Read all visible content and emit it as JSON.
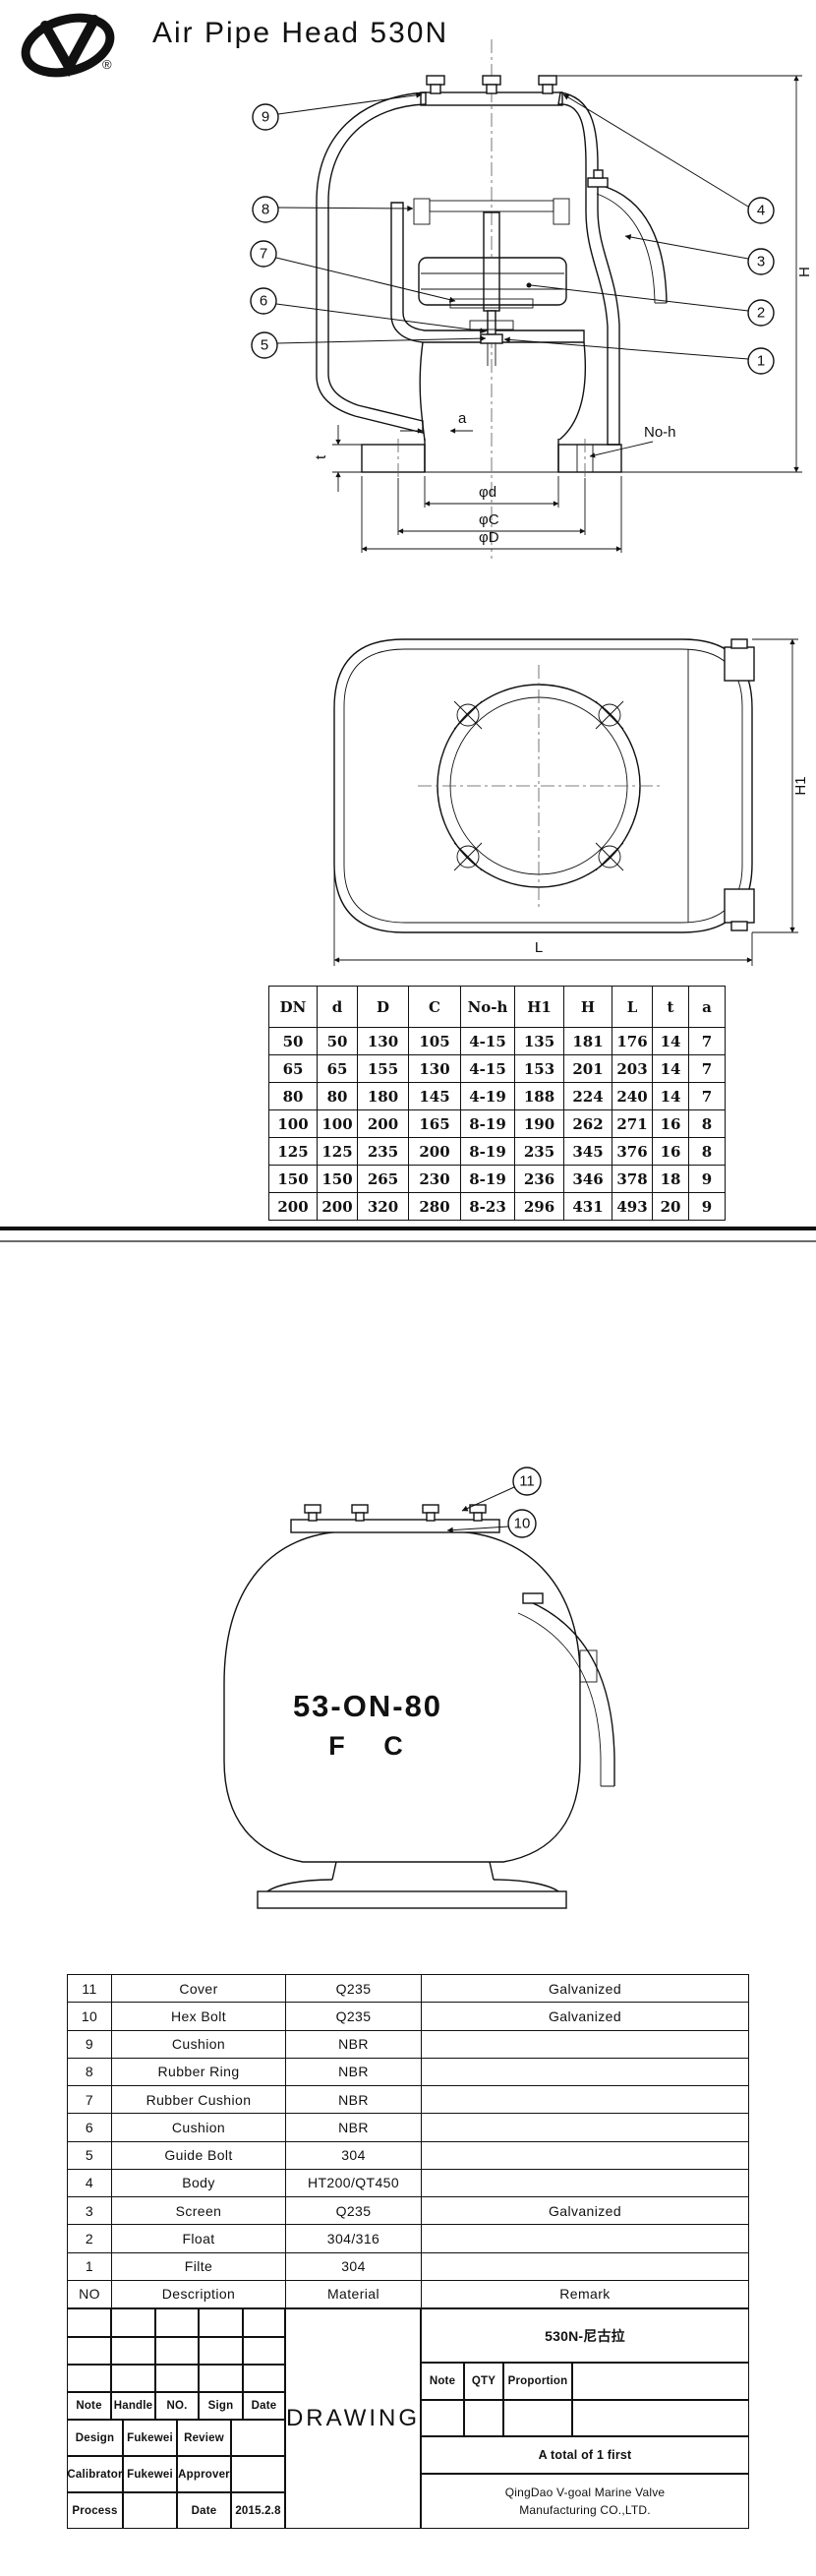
{
  "header": {
    "title": "Air Pipe Head 530N",
    "registered": "®"
  },
  "fig1": {
    "callouts_left": [
      "9",
      "8",
      "7",
      "6",
      "5"
    ],
    "callouts_right": [
      "4",
      "3",
      "2",
      "1"
    ],
    "labels": {
      "a": "a",
      "t": "t",
      "no_h": "No-h",
      "H": "H",
      "phi_d": "φd",
      "phi_C": "φC",
      "phi_D": "φD"
    }
  },
  "fig2": {
    "labels": {
      "H1": "H1",
      "L": "L"
    }
  },
  "fig3": {
    "callouts": [
      "11",
      "10"
    ],
    "model": "53-ON-80",
    "type_letters": "F C"
  },
  "dims_table": {
    "headers": [
      "DN",
      "d",
      "D",
      "C",
      "No-h",
      "H1",
      "H",
      "L",
      "t",
      "a"
    ],
    "rows": [
      [
        "50",
        "50",
        "130",
        "105",
        "4-15",
        "135",
        "181",
        "176",
        "14",
        "7"
      ],
      [
        "65",
        "65",
        "155",
        "130",
        "4-15",
        "153",
        "201",
        "203",
        "14",
        "7"
      ],
      [
        "80",
        "80",
        "180",
        "145",
        "4-19",
        "188",
        "224",
        "240",
        "14",
        "7"
      ],
      [
        "100",
        "100",
        "200",
        "165",
        "8-19",
        "190",
        "262",
        "271",
        "16",
        "8"
      ],
      [
        "125",
        "125",
        "235",
        "200",
        "8-19",
        "235",
        "345",
        "376",
        "16",
        "8"
      ],
      [
        "150",
        "150",
        "265",
        "230",
        "8-19",
        "236",
        "346",
        "378",
        "18",
        "9"
      ],
      [
        "200",
        "200",
        "320",
        "280",
        "8-23",
        "296",
        "431",
        "493",
        "20",
        "9"
      ]
    ]
  },
  "parts_table": {
    "rows": [
      [
        "11",
        "Cover",
        "Q235",
        "Galvanized"
      ],
      [
        "10",
        "Hex Bolt",
        "Q235",
        "Galvanized"
      ],
      [
        "9",
        "Cushion",
        "NBR",
        ""
      ],
      [
        "8",
        "Rubber Ring",
        "NBR",
        ""
      ],
      [
        "7",
        "Rubber Cushion",
        "NBR",
        ""
      ],
      [
        "6",
        "Cushion",
        "NBR",
        ""
      ],
      [
        "5",
        "Guide Bolt",
        "304",
        ""
      ],
      [
        "4",
        "Body",
        "HT200/QT450",
        ""
      ],
      [
        "3",
        "Screen",
        "Q235",
        "Galvanized"
      ],
      [
        "2",
        "Float",
        "304/316",
        ""
      ],
      [
        "1",
        "Filte",
        "304",
        ""
      ],
      [
        "NO",
        "Description",
        "Material",
        "Remark"
      ]
    ]
  },
  "title_block": {
    "left": {
      "note": "Note",
      "handle": "Handle",
      "no": "NO.",
      "sign": "Sign",
      "date": "Date",
      "design": "Design",
      "design_name": "Fukewei",
      "review": "Review",
      "calibrator": "Calibrator",
      "calibrator_name": "Fukewei",
      "approver": "Approver",
      "process": "Process",
      "date_label": "Date",
      "date_value": "2015.2.8"
    },
    "center": {
      "drawing": "DRAWING"
    },
    "right": {
      "model_cn": "530N-尼古拉",
      "note": "Note",
      "qty": "QTY",
      "proportion": "Proportion",
      "total": "A total of 1 first",
      "company_line1": "QingDao V-goal Marine Valve",
      "company_line2": "Manufacturing CO.,LTD."
    }
  }
}
